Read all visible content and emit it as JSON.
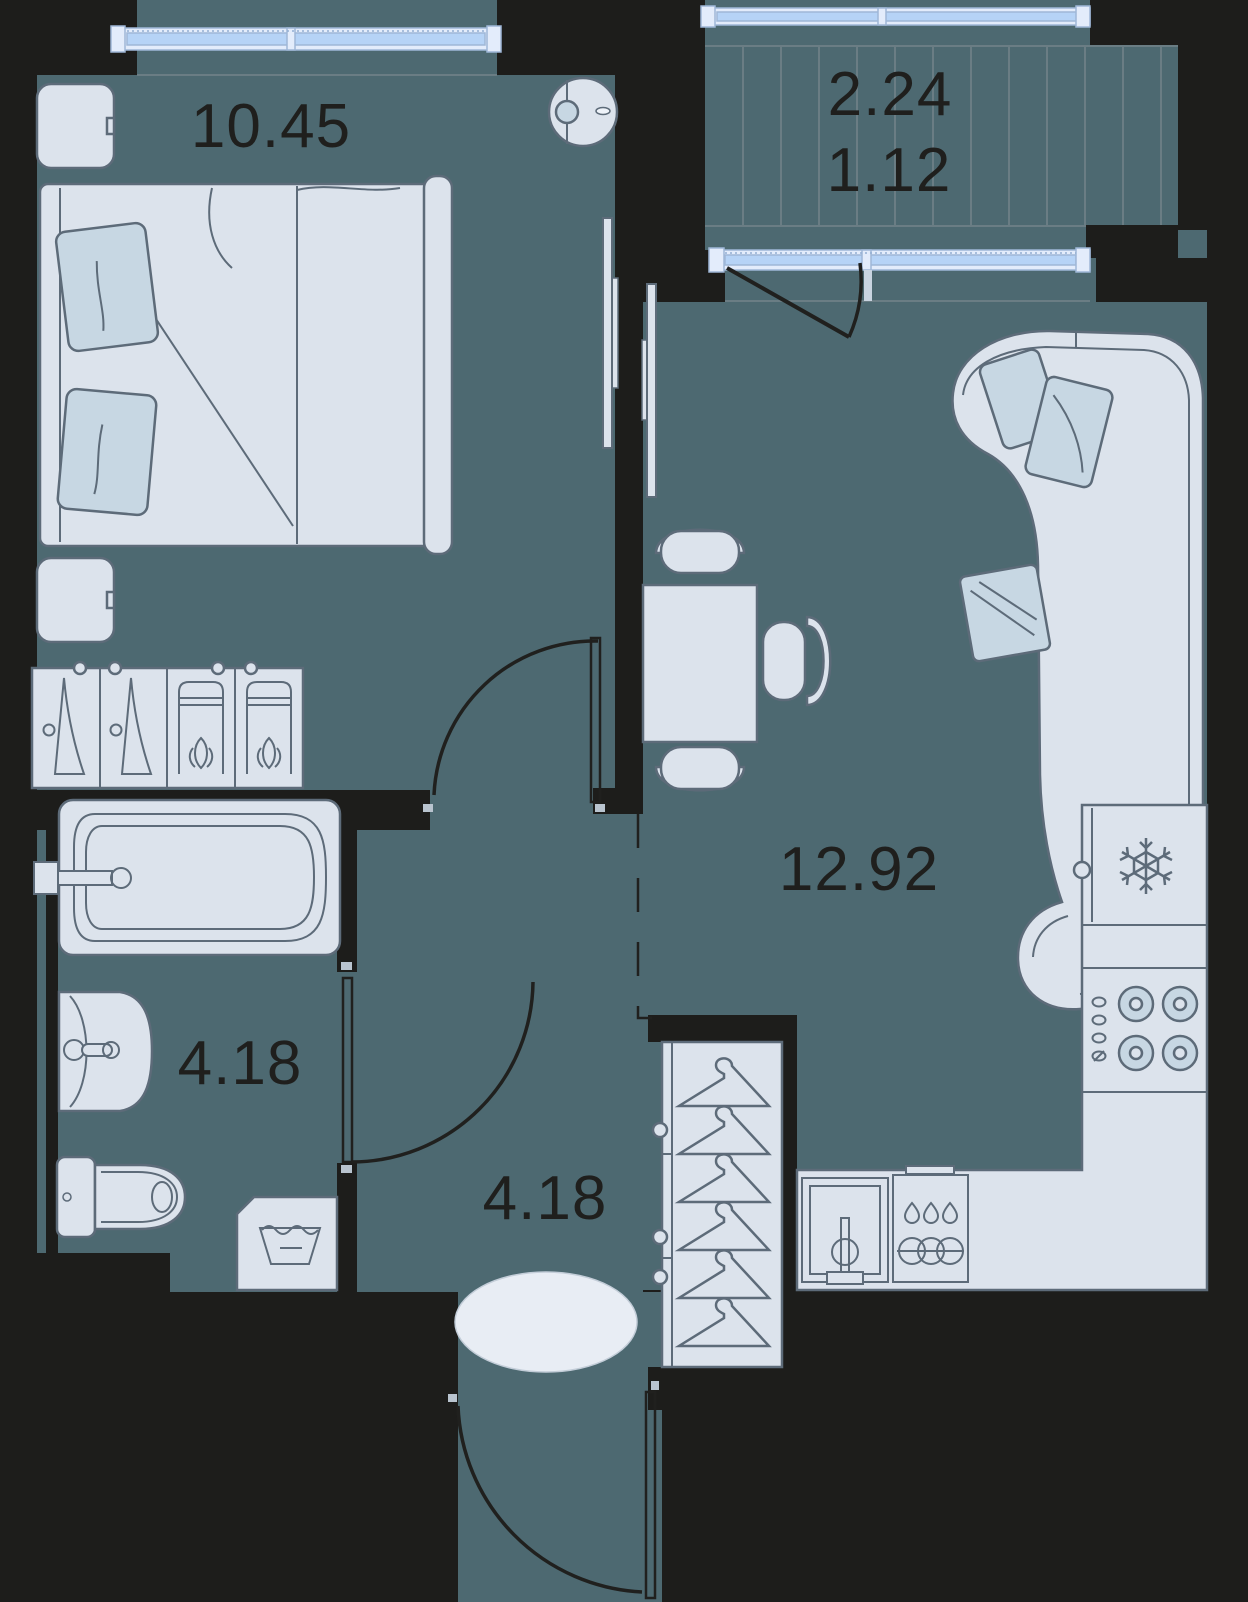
{
  "plan_type": "apartment-floor-plan",
  "rooms": {
    "bedroom": {
      "name": "bedroom",
      "area": "10.45"
    },
    "balcony": {
      "name": "balcony",
      "area_total": "2.24",
      "area_reduced": "1.12"
    },
    "kitchen_living": {
      "name": "kitchen-living-room",
      "area": "12.92"
    },
    "bathroom": {
      "name": "bathroom",
      "area": "4.18"
    },
    "hallway": {
      "name": "hallway",
      "area": "4.18"
    }
  },
  "palette": {
    "background": "#1d1d1b",
    "wall": "#1d1d1b",
    "floor": "#4d6971",
    "floor_line": "#6a7d84",
    "furniture_fill": "#dce3ec",
    "furniture_fill_alt": "#c7d7e3",
    "furniture_outline": "#5d6b79",
    "window_frame": "#e3ecfb",
    "window_glass": "#b6d3f6",
    "window_stroke": "#9fb7d7",
    "rug_fill": "#e8edf4",
    "door_line": "#20201e",
    "text": "#1f1f1d"
  },
  "icons": [
    "snowflake-icon",
    "water-icon",
    "hanger-icon",
    "hanger-side-icon",
    "garment-bag-icon",
    "burner-icon",
    "drop-icon",
    "faucet-icon"
  ],
  "furniture": [
    "double-bed",
    "pillow",
    "nightstand",
    "dresser",
    "robot-vacuum",
    "tv",
    "dining-table",
    "chair",
    "sofa",
    "fridge",
    "stove",
    "kitchen-counter",
    "kitchen-sink",
    "dishwasher",
    "wardrobe",
    "bathtub",
    "vanity-sink",
    "toilet",
    "washing-machine",
    "rug"
  ]
}
